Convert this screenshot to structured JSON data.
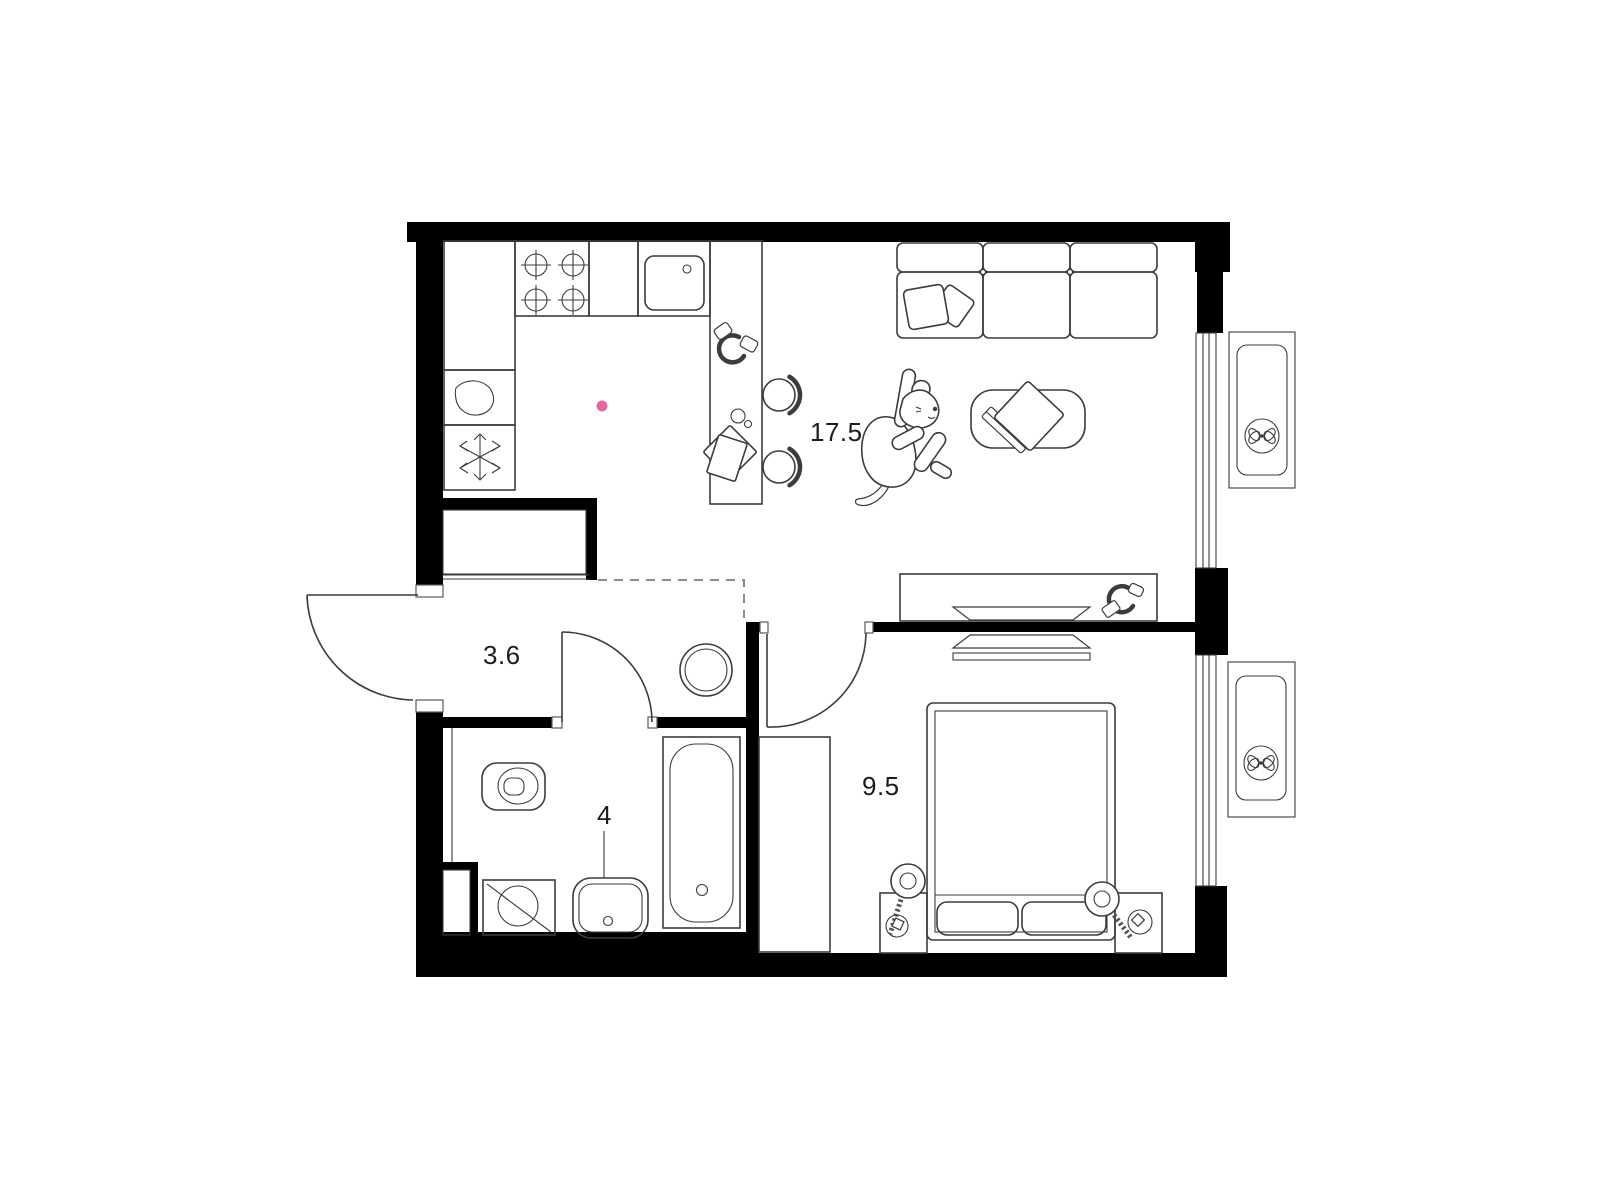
{
  "plan_title": "apartment-floor-plan",
  "rooms": [
    {
      "key": "living-kitchen",
      "area": "17.5"
    },
    {
      "key": "hallway",
      "area": "3.6"
    },
    {
      "key": "bathroom",
      "area": "4"
    },
    {
      "key": "bedroom",
      "area": "9.5"
    }
  ],
  "colors": {
    "walls": "#000000",
    "lines": "#3c3c3c",
    "dashed_boundary": "#8a8a8a",
    "accent_dot": "#e2699e",
    "background": "#ffffff",
    "label_text": "#1c1c1c"
  },
  "icons": [
    "stove-burners-icon",
    "kitchen-sink-icon",
    "water-drop-icon",
    "snowflake-icon",
    "headphones-icon",
    "cup-icon",
    "cutting-board-icon",
    "bar-stool-icon",
    "sofa-icon",
    "pillow-icon",
    "coffee-table-icon",
    "books-icon",
    "dog-illustration",
    "tv-icon",
    "tv-console-icon",
    "pouf-icon",
    "toilet-icon",
    "washing-machine-icon",
    "bathroom-sink-icon",
    "bathtub-icon",
    "wardrobe-icon",
    "double-bed-icon",
    "nightstand-icon",
    "table-lamp-icon",
    "window-icon",
    "ventilation-fan-icon",
    "door-swing-icon",
    "smoke-detector-dot"
  ]
}
